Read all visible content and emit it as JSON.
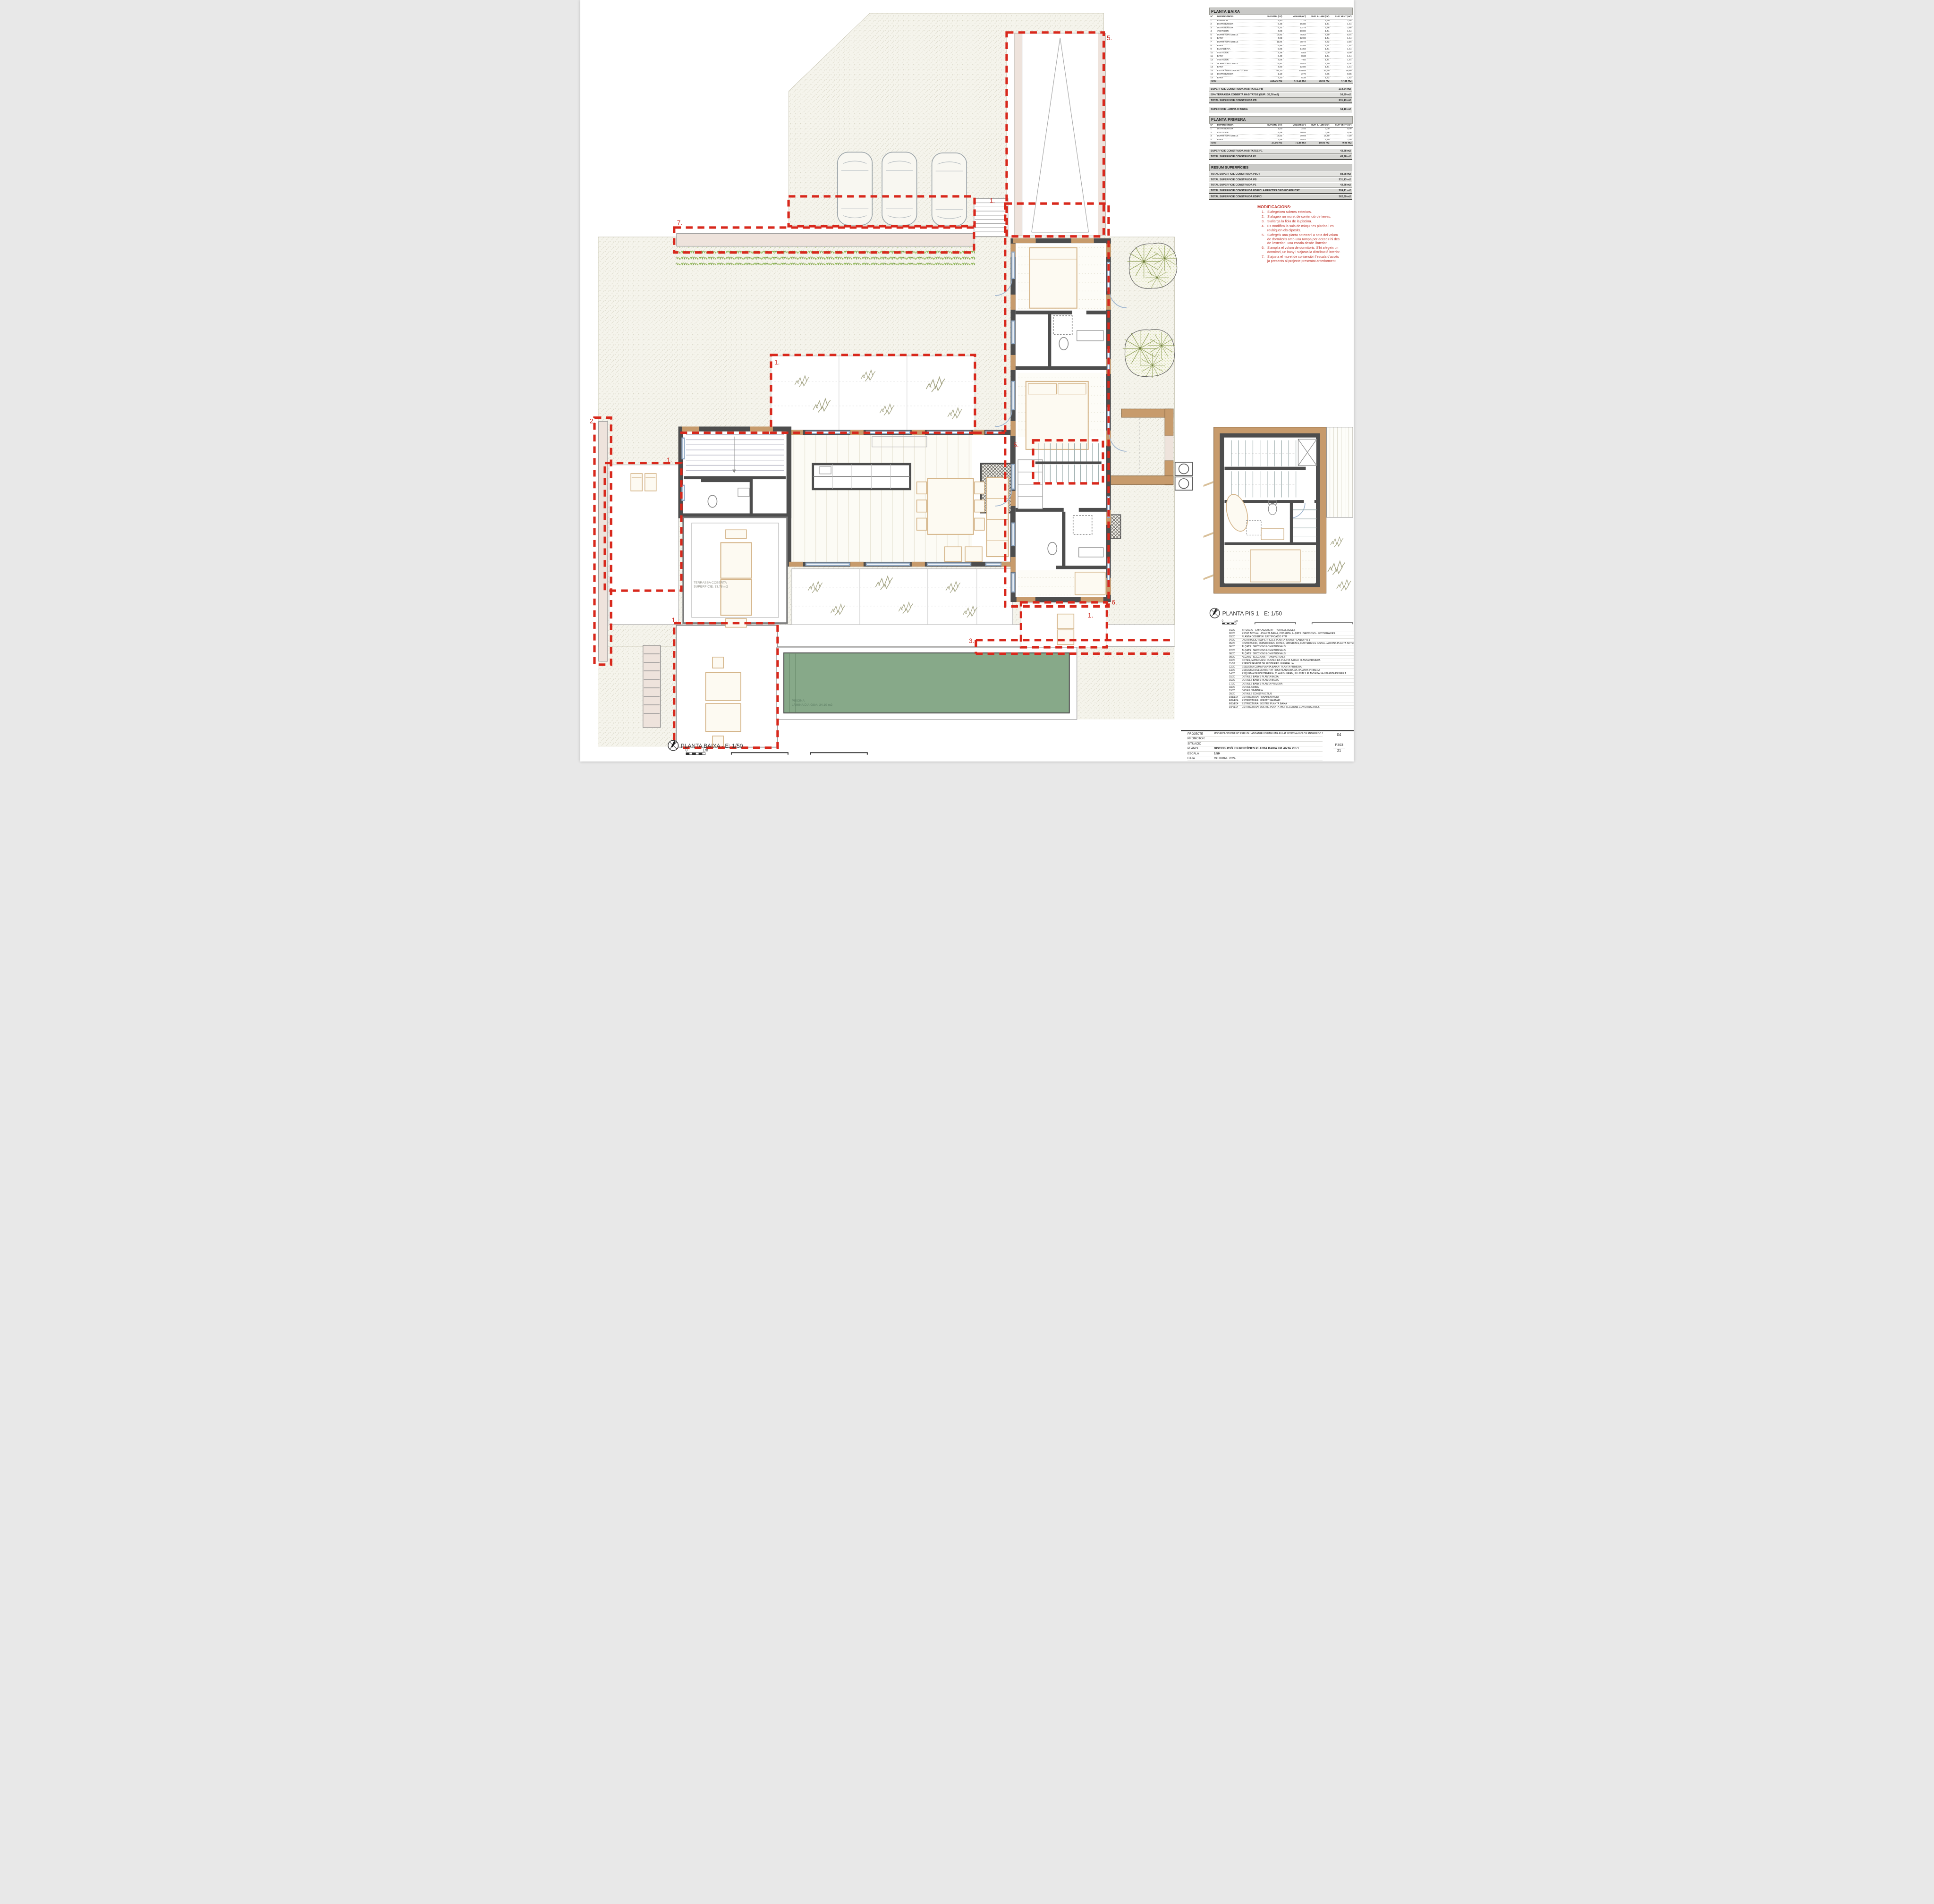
{
  "pb": {
    "title": "PLANTA BAIXA",
    "headers": [
      "Nº",
      "DEPENDÈNCIA",
      "SUP.ÚTIL (m²)",
      "VOLUM (m³)",
      "SUP. IL·LUM (m²)",
      "SUP. VENT (m²)"
    ],
    "rows": [
      [
        "1",
        "REBEDOR",
        "4,80",
        "11,76",
        "9,60",
        "2,16"
      ],
      [
        "2",
        "DISTRIBUÏDOR",
        "6,48",
        "15,88",
        "1,44",
        "1,44"
      ],
      [
        "3",
        "DISTRIBUÏDOR",
        "5,22",
        "12,79",
        "2,88",
        "2,88"
      ],
      [
        "4",
        "VESTIDOR",
        "4,08",
        "10,00",
        "1,44",
        "1,44"
      ],
      [
        "5",
        "DORMITORI DOBLE",
        "13,92",
        "45,52",
        "7,20",
        "5,04"
      ],
      [
        "6",
        "BANY",
        "4,93",
        "12,08",
        "1,44",
        "1,44"
      ],
      [
        "7",
        "DORMITORI DOBLE",
        "11,84",
        "38,72",
        "4,32",
        "2,16"
      ],
      [
        "8",
        "BANY",
        "5,95",
        "14,58",
        "1,44",
        "1,44"
      ],
      [
        "9",
        "BUGADERIA",
        "5,95",
        "14,58",
        "1,44",
        "1,44"
      ],
      [
        "10",
        "VESTIDOR",
        "2,38",
        "5,83",
        "0,00",
        "0,00"
      ],
      [
        "11",
        "BANY",
        "3,40",
        "8,33",
        "1,44",
        "1,44"
      ],
      [
        "12",
        "VESTIDOR",
        "3,06",
        "7,50",
        "1,44",
        "1,44"
      ],
      [
        "13",
        "DORMITORI DOBLE",
        "13,92",
        "45,52",
        "7,20",
        "5,04"
      ],
      [
        "14",
        "BANY",
        "4,90",
        "12,00",
        "1,44",
        "1,44"
      ],
      [
        "15",
        "ESTAR / MENJADOR / CUINA",
        "64,20",
        "209,93",
        "33,60",
        "16,80"
      ],
      [
        "16",
        "DISTRIBUÏDOR",
        "1,10",
        "2,70",
        "0,36",
        "0,36"
      ],
      [
        "17",
        "BANY",
        "2,20",
        "5,39",
        "1,92",
        "1,92"
      ],
      [
        "TOTALS",
        "",
        "158,36 m2",
        "473,16 m3",
        "78,60 m2",
        "47,88 m2"
      ]
    ]
  },
  "pb_summary": [
    {
      "label": "SUPERFÍCIE CONSTRUÏDA HABITATGE PB",
      "value": "214,24 m2"
    },
    {
      "label": "50% TERRASSA COBERTA HABITATGE (SUP.: 33,78 m2)",
      "value": "16,89 m2"
    },
    {
      "label": "TOTAL SUPERFÍCIE CONSTRUÏDA PB",
      "value": "231,13 m2",
      "strong": true
    }
  ],
  "lamina": [
    {
      "label": "SUPERFÍCIE LÀMINA D'AIGUA",
      "value": "34,10 m2"
    }
  ],
  "p1": {
    "title": "PLANTA PRIMERA",
    "headers": [
      "Nº",
      "DEPENDÈNCIA",
      "SUP.ÚTIL (m²)",
      "VOLUM (m³)",
      "SUP. IL·LUM (m²)",
      "SUP. VENT (m²)"
    ],
    "rows": [
      [
        "1",
        "DISTRIBUÏDOR",
        "1,00",
        "2,45",
        "0,00",
        "0,00"
      ],
      [
        "2",
        "VESTIDOR",
        "4,48",
        "10,93",
        "0,36",
        "0,36"
      ],
      [
        "3",
        "DORMITORI DOBLE",
        "14,52",
        "39,93",
        "14,40",
        "7,20"
      ],
      [
        "4",
        "BANY",
        "7,56",
        "18,52",
        "4,80",
        "2,40"
      ],
      [
        "TOTALS",
        "",
        "27,56 m2",
        "71,88 m3",
        "19,56 m2",
        "9,96 m2"
      ]
    ]
  },
  "p1_summary": [
    {
      "label": "SUPERFÍCIE CONSTRUÏDA HABITATGE P1",
      "value": "43,28 m2"
    },
    {
      "label": "TOTAL SUPERFÍCIE CONSTRUÏDA P1",
      "value": "43,28 m2",
      "strong": true
    }
  ],
  "resum": {
    "title": "RESUM SUPERFÍCIES",
    "rows": [
      {
        "label": "TOTAL SUPERFÍCIE CONSTRUÏDA PSOT",
        "value": "88,28 m2"
      },
      {
        "label": "TOTAL SUPERFÍCIE CONSTRUÏDA PB",
        "value": "231,13 m2"
      },
      {
        "label": "TOTAL SUPERFÍCIE CONSTRUÏDA P1",
        "value": "43,28 m2"
      },
      {
        "label": "TOTAL SUPERFÍCIE CONSTRUÏDA EDIFICI A EFECTES D'EDIFICABILITAT",
        "value": "274,41 m2",
        "strong": true
      },
      {
        "label": "TOTAL SUPERFÍCIE CONSTRUÏDA EDIFICI",
        "value": "362,69 m2",
        "strong": true
      }
    ]
  },
  "modificacions": {
    "title": "MODIFICACIONS:",
    "items": [
      "S'afegeixen soleres exteriors.",
      "S'afageix un muret de contenció de terres.",
      "S'allarga la fiola de la piscina.",
      "Es modifica la sala de màquines piscina i es reubiquen els dipòsits.",
      "S'afegeix una planta soterrani a sota del volum de dormitoris amb una rampa per accedir-hi des de l'exterior i una escala desde l'interior.",
      "S'amplia el volum de dormitoris. S'hi afegeix un dormitori, un bany i s'ajusta la distribució interior.",
      "S'ajusta el muret de contenció i l'escala d'accés ja presents al projecte presentat anteriorment."
    ]
  },
  "drawing_index": [
    {
      "num": "01/20",
      "title": "SITUACIÓ - EMPLAÇAMENT - PORTELL ACCÉS"
    },
    {
      "num": "02/20",
      "title": "ESTAT ACTUAL - PLANTA BAIXA, COBERTA, ALÇATS I SECCIONS - FOTOGRAFIES"
    },
    {
      "num": "03/20",
      "title": "PLANTA COBERTA I JUSTIFICACIÓ PTM"
    },
    {
      "num": "04/20",
      "title": "DISTRIBUCIÓ I SUPERFÍCIES PLANTA BAIXA I PLANTA PIS 1"
    },
    {
      "num": "05/20",
      "title": "DISTRIBUCIÓ, SUPERFÍCIES, COTES, MATERIALS, FUSTERIES E INSTAL·LACIONS PLANTA SOTERRANI"
    },
    {
      "num": "06/20",
      "title": "ALÇATS I SECCIONS LONGITUDINALS"
    },
    {
      "num": "07/20",
      "title": "ALÇATS I SECCIONS LONGITUDINALS"
    },
    {
      "num": "08/20",
      "title": "ALÇATS I SECCIONS LONGITUDINALS"
    },
    {
      "num": "09/20",
      "title": "ALÇATS I SECCIONS TRANSVERSALS"
    },
    {
      "num": "10/20",
      "title": "COTES, MATERIALS I FUSTERIES PLANTA BAIXA I PLANTA PRIMERA"
    },
    {
      "num": "11/20",
      "title": "ESPECEJAMENT DE FUSTERIES I FERRALLA"
    },
    {
      "num": "12/20",
      "title": "ESQUEMA CLIMA PLANTA BAIXA I PLANTA PRIMERA"
    },
    {
      "num": "13/20",
      "title": "ESQUEMA D'ELECTRICITAT I HS3 PLANTA BAIXA I PLANTA PRIMERA"
    },
    {
      "num": "14/20",
      "title": "ESQUEMA DE FONTANERIA, CLAVEGUERAM, PLUVIALS PLANTA BAIXA I PLANTA PRIMERA"
    },
    {
      "num": "15/20",
      "title": "DETALLS BANYS PLANTA BAIXA"
    },
    {
      "num": "16/20",
      "title": "DETALLS BANYS PLANTA BAIXA"
    },
    {
      "num": "17/20",
      "title": "DETALLS BANYS PLANTA PRIMERA"
    },
    {
      "num": "18/20",
      "title": "DETALL CUINA"
    },
    {
      "num": "19/20",
      "title": "DETALL XIMENEIA"
    },
    {
      "num": "20/20",
      "title": "DETALLS CONSTRUCTIUS"
    },
    {
      "num": "E01/E04",
      "title": "ESTRUCTURA: FONAMENTACIÓ"
    },
    {
      "num": "E02/E04",
      "title": "ESTRUCTURA: FORJAT SANITARI"
    },
    {
      "num": "E03/E04",
      "title": "ESTRUCTURA: SOSTRE PLANTA BAIXA"
    },
    {
      "num": "E04/E04",
      "title": "ESTRUCTURA: SOSTRE PLANTA PIS I SECCIONS CONSTRUCTIVES"
    }
  ],
  "title_block": {
    "projecte_label": "PROJECTE",
    "projecte": "MODIFICACIÓ P.BÀSIC PER UN HABITATGE UNIFAMILIAR AÏLLAT I PISCINA INCLÒS ENDERROC DE CONSTRUCCIÓ EXISTENT",
    "promotor_label": "PROMOTOR",
    "promotor": "",
    "situacio_label": "SITUACIÓ",
    "situacio": "",
    "planol_label": "PLÀNOL",
    "planol": "DISTRIBUCIÓ I SUPERFÍCIES PLANTA BAIXA I PLANTA PIS 1",
    "escala_label": "ESCALA",
    "escala": "1/50",
    "data_label": "DATA",
    "data": "OCTUBRE 2024",
    "sheet_num": "04",
    "code": "P303",
    "total": "21"
  },
  "plan_labels": {
    "planta_baixa": "PLANTA BAIXA - E: 1/50",
    "planta_pis1": "PLANTA PIS 1 - E: 1/50",
    "s0": "0",
    "s1m": "1m"
  },
  "callouts": {
    "c1": "1.",
    "c2": "2.",
    "c3": "3.",
    "c5": "5.",
    "c6": "6.",
    "c7": "7."
  },
  "notes": {
    "terrassa_l1": "TERRASSA COBERTA",
    "terrassa_l2": "SUPERFÍCIE: 33,78 m2",
    "piscina_l1": "PISCINA",
    "piscina_l2": "LÀMINA D'AIGUA: 34,10 m2"
  },
  "colors": {
    "red_dash": "#d8281c",
    "wall": "#4d4d4d",
    "timber": "#c79b6c",
    "pool": "#87a989",
    "paving_pink": "#eee3dc",
    "site": "#f5f4ec",
    "hedge_green": "#7fae3f",
    "mods_red": "#c2382e"
  }
}
